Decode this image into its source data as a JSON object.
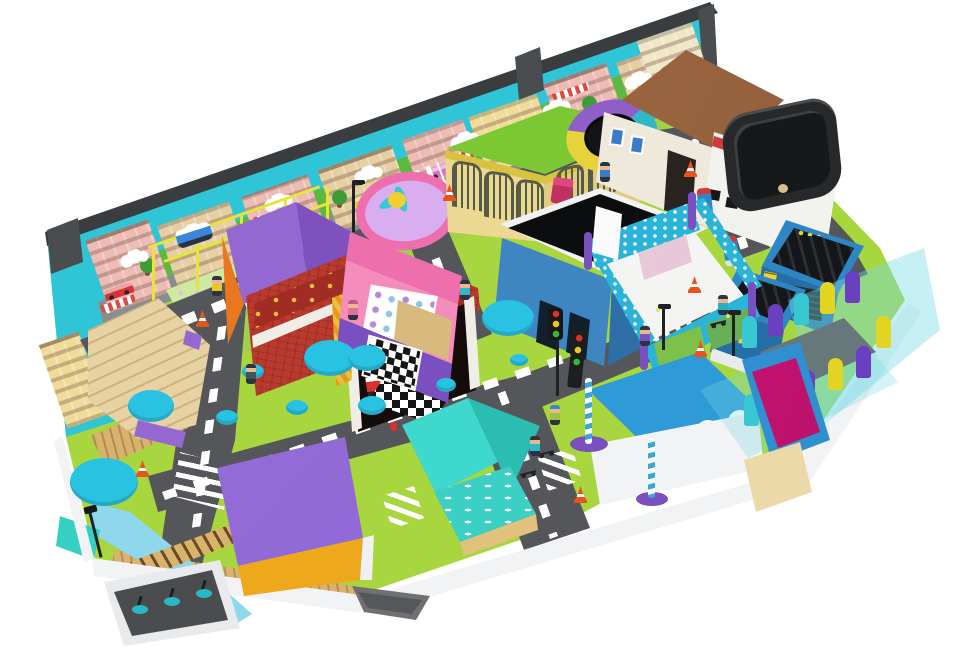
{
  "image": {
    "type": "3d-render",
    "subject": "indoor playground role-play mini city with roads, shops and soft-play equipment",
    "background": "#ffffff"
  },
  "palette": {
    "sky": "#2fc5d7",
    "hill": "#5cb83e",
    "wallEdge": "#3a3d40",
    "grass": "#a8d63e",
    "grassLight": "#c9e67e",
    "road": "#54565a",
    "line": "#ffffff",
    "wood": "#d9b26b",
    "river": "#8fd8ec",
    "plate": "#f2f3f4",
    "plateShade": "#d9dbdd",
    "tree": "#2ac2e2",
    "cage": "#e8e438",
    "zooRoof": "#7cc832",
    "zooWall": "#ead893",
    "zooTrim": "#d8c23e",
    "gate": "#565b48",
    "tramTeal": "#2fb9c7",
    "tramPurple": "#8f5fc7",
    "tramYellow": "#e8d23c",
    "mat": "#141416",
    "roofBrown": "#a9714b",
    "roofBrownDark": "#8a5835",
    "houseWall": "#efe9dc",
    "windowBlue": "#3a7bc8",
    "pitBody": "#f2f2ef",
    "pitTop": "#26282a",
    "pitHole": "#17181a",
    "redStripe": "#d03a3a",
    "kioskBlue": "#2f86c4",
    "kioskBlueDark": "#256ea6",
    "gridDark": "#141619",
    "yellow": "#e8d23c",
    "fireRoof": "#9468d0",
    "fireRoofDark": "#7e51be",
    "orange": "#e87820",
    "brick": "#bb3a2e",
    "brickDark": "#a12c24",
    "garage": "#140b0a",
    "truckRed": "#d8322a",
    "pinkWall": "#f48cbc",
    "pinkHot": "#ee6fae",
    "purple": "#7a4fc0",
    "floorTan": "#d8b97e",
    "blackRoof": "#0c0d0f",
    "blueWall": "#3e86c2",
    "blueWallDark": "#2f6fa8",
    "fenceTeal": "#2ab4d8",
    "stepTan": "#e6d2a2",
    "roofPurple": "#8a5fd0",
    "frontYellow": "#eda81c",
    "tealRoof": "#3ed8cc",
    "tealRoofDark": "#2bbcb2",
    "tealWall": "#3ccfc3",
    "baseTan": "#e0c27c",
    "poolBlue": "#2f9ad8",
    "ballBlue": "#2f8fd0",
    "magenta": "#cf1478",
    "sand": "#ecd9a8",
    "glass": "rgba(120,220,228,0.42)",
    "pillarTeal": "#38c8d4",
    "pillarPurple": "#6a3fc0",
    "pillarYellow": "#e3d422",
    "pillarBlue": "#2f6fc0",
    "platform": "#4a4c4e",
    "cone": "#e8541e",
    "sigRed": "#e03028",
    "sigYellow": "#e8c820",
    "sigGreen": "#38b838",
    "pole": "#1f2124",
    "candy": "#35a8d8",
    "skin": "#eab88c",
    "muralPink": "#edbcb4",
    "muralTan": "#e7cfa4",
    "muralYellow": "#f0dc9a",
    "awning": "#e04840",
    "muralRoad": "#8a8d90",
    "muralTree": "#3e9c38",
    "bed": "#cdeaa0"
  },
  "scene": {
    "description": "Isometric render of a children's indoor playground town on a white floor plate",
    "elements": [
      {
        "name": "backdrop-mural-wall",
        "color": "#2fc5d7"
      },
      {
        "name": "mural-hill-band",
        "color": "#5cb83e"
      },
      {
        "name": "mural-street",
        "color": "#8a8d90"
      },
      {
        "name": "mural-buildings",
        "color": "#edbcb4"
      },
      {
        "name": "mural-cars",
        "color": "#d63434"
      },
      {
        "name": "play-cage-frame",
        "color": "#e8e438"
      },
      {
        "name": "toy-bus",
        "color": "#3a86d8"
      },
      {
        "name": "flower-fountain",
        "color": "#ee6fae"
      },
      {
        "name": "zoo-gate-house",
        "color": "#7cc832"
      },
      {
        "name": "round-trampoline",
        "color": "#8f5fc7"
      },
      {
        "name": "brown-roof-cottage",
        "color": "#a9714b"
      },
      {
        "name": "foam-pit-building",
        "color": "#26282a"
      },
      {
        "name": "gas-station-kiosks",
        "color": "#2f86c4"
      },
      {
        "name": "fuel-pumps",
        "color": "#2f86c4"
      },
      {
        "name": "fire-station",
        "color": "#bb3a2e"
      },
      {
        "name": "fire-trucks",
        "color": "#d8322a"
      },
      {
        "name": "pet-shop",
        "color": "#f48cbc"
      },
      {
        "name": "black-roof-stage",
        "color": "#0c0d0f"
      },
      {
        "name": "fenced-play-pen",
        "color": "#2ab4d8"
      },
      {
        "name": "tiered-tan-building",
        "color": "#e6d2a2"
      },
      {
        "name": "purple-roof-warehouse",
        "color": "#8a5fd0"
      },
      {
        "name": "teal-roof-cottage",
        "color": "#3ed8cc"
      },
      {
        "name": "wave-roof-building",
        "color": "#2f9ad8"
      },
      {
        "name": "ball-pool",
        "color": "#cf1478"
      },
      {
        "name": "glass-soft-fence",
        "color": "#38c8d4"
      },
      {
        "name": "ride-platform",
        "color": "#4a4c4e"
      },
      {
        "name": "river",
        "color": "#8fd8ec"
      },
      {
        "name": "railroad-track",
        "color": "#d9b26b"
      },
      {
        "name": "road-network",
        "color": "#54565a"
      },
      {
        "name": "crosswalks",
        "color": "#ffffff"
      },
      {
        "name": "traffic-light",
        "colors": [
          "#e03028",
          "#e8c820",
          "#38b838"
        ]
      },
      {
        "name": "street-lamps",
        "color": "#1f2124"
      },
      {
        "name": "candy-stripe-poles",
        "color": "#35a8d8"
      },
      {
        "name": "traffic-cones",
        "color": "#e8541e"
      },
      {
        "name": "cyan-trees",
        "color": "#2ac2e2"
      },
      {
        "name": "kid-figures",
        "color": "#eab88c"
      },
      {
        "name": "kick-scooters",
        "color": "#20242a"
      },
      {
        "name": "security-camera-pole",
        "color": "#1f2124"
      },
      {
        "name": "white-base-plate",
        "color": "#f2f3f4"
      }
    ]
  }
}
